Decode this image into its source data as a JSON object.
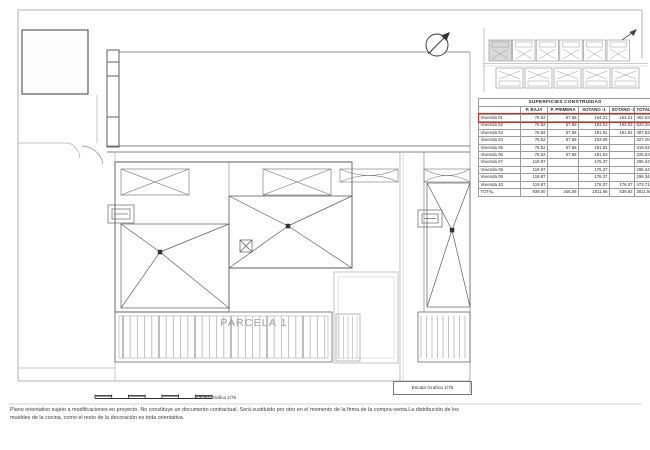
{
  "document": {
    "parcel_label": "PARCELA 1",
    "scale_box_label": "Escala Grafica 1/75",
    "scale_bar_label": "Escala Grafica 1/75",
    "disclaimer_line1": "Plano orientativo sujeto a modificaciones en proyecto. No constituye un documento contractual. Será sustituido por otro en el momento de la firma de la compra-venta.La distribución de los",
    "disclaimer_line2": "muebles de la cocina, como el resto de la decoración es toda orientativa."
  },
  "table": {
    "title": "SUPERFICIES CONSTRUIDAS",
    "columns": [
      "",
      "P. BAJA",
      "P. PRIMERA",
      "SOTANO -1",
      "SOTANO -2",
      "TOTAL"
    ],
    "rows": [
      [
        "Vivienda 01",
        "76.52",
        "57.68",
        "164.21",
        "164.21",
        "462.62"
      ],
      [
        "Vivienda 02",
        "76.52",
        "57.68",
        "193.03",
        "193.03",
        "520.26"
      ],
      [
        "Vivienda 03",
        "76.52",
        "57.68",
        "191.81",
        "191.81",
        "487.82"
      ],
      [
        "Vivienda 04",
        "76.52",
        "57.68",
        "193.06",
        "",
        "327.26"
      ],
      [
        "Vivienda 05",
        "76.52",
        "57.68",
        "191.84",
        "",
        "318.04"
      ],
      [
        "Vivienda 06",
        "76.52",
        "57.68",
        "191.63",
        "",
        "325.63"
      ],
      [
        "Vivienda 07",
        "119.97",
        "",
        "176.37",
        "",
        "296.34"
      ],
      [
        "Vivienda 08",
        "119.97",
        "",
        "176.37",
        "",
        "296.34"
      ],
      [
        "Vivienda 09",
        "119.97",
        "",
        "176.37",
        "",
        "296.34"
      ],
      [
        "Vivienda 10",
        "119.97",
        "",
        "176.37",
        "176.37",
        "473.71"
      ],
      [
        "TOTAL",
        "939.00",
        "346.08",
        "1811.66",
        "539.83",
        "3811.56"
      ]
    ],
    "highlight_row_index": 0,
    "highlight_color": "#e8251f"
  },
  "colors": {
    "line_dark": "#4f4f4f",
    "line_mid": "#6a6a6a",
    "line_light": "#b0b0b0",
    "shade_unit": "#d9d9d9"
  }
}
